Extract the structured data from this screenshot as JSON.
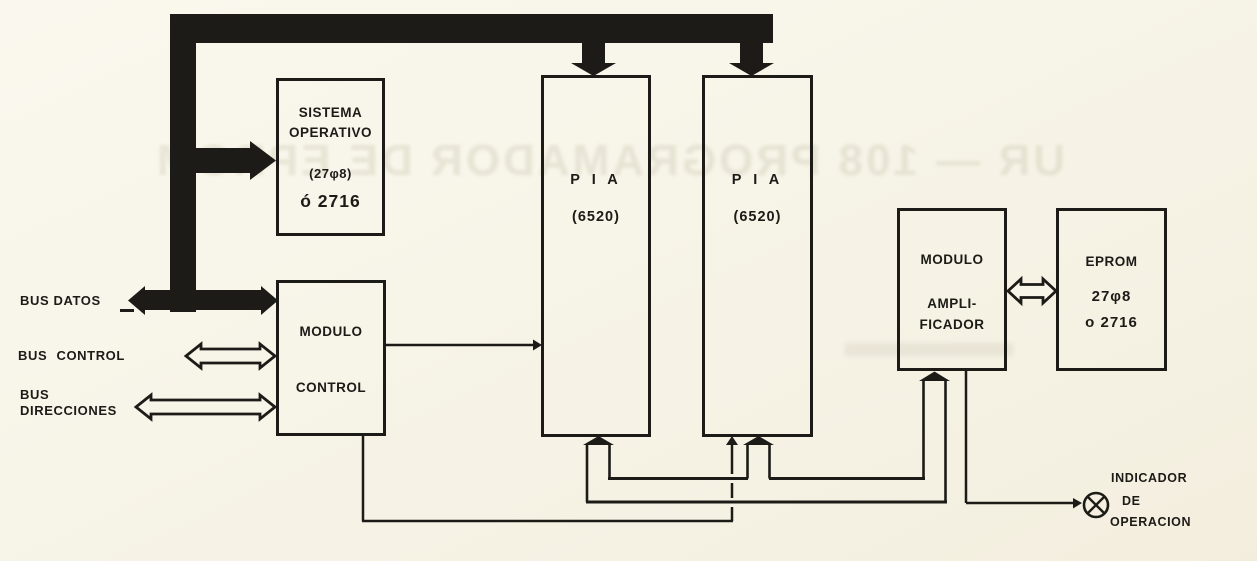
{
  "colors": {
    "paper": "#f7f4e8",
    "ink": "#1d1b17"
  },
  "blocks": {
    "sistema_operativo": {
      "line1": "SISTEMA",
      "line2": "OPERATIVO",
      "line3": "(27φ8)",
      "line4": "ó 2716"
    },
    "pia1": {
      "name": "P I A",
      "chip": "(6520)"
    },
    "pia2": {
      "name": "P I A",
      "chip": "(6520)"
    },
    "modulo_control": {
      "line1": "MODULO",
      "line2": "CONTROL"
    },
    "modulo_amplificador": {
      "line1": "MODULO",
      "line2": "AMPLI-",
      "line3": "FICADOR"
    },
    "eprom": {
      "line1": "EPROM",
      "line2": "27φ8",
      "line3": "o 2716"
    }
  },
  "bus_labels": {
    "datos": "BUS DATOS",
    "control": "BUS CONTROL",
    "direcciones_line1": "BUS",
    "direcciones_line2": "DIRECCIONES"
  },
  "indicator": {
    "line1": "INDICADOR",
    "line2": "DE",
    "line3": "OPERACION"
  },
  "ghost": {
    "bleed_text": "UR — 108 PROGRAMADOR DE EPROM"
  }
}
